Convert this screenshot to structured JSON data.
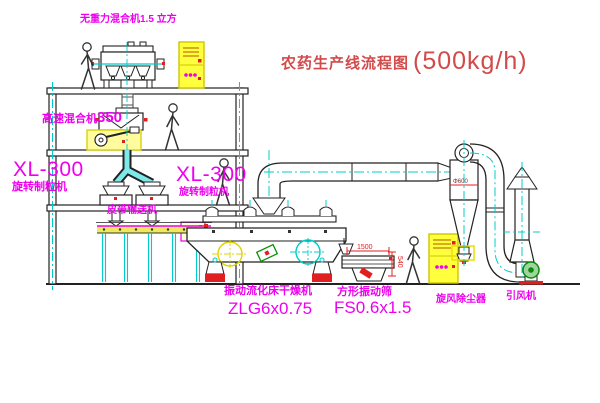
{
  "title": {
    "name": "农药生产线流程图",
    "capacity": "(500kg/h)"
  },
  "labels": {
    "gravity_mixer": "无重力混合机1.5 立方",
    "speed_mixer_name": "高速混合机",
    "speed_mixer_num": "350",
    "granulator_left_model": "XL-300",
    "granulator_left_name": "旋转制粒机",
    "granulator_right_model": "XL-300",
    "granulator_right_name": "旋转制粒机",
    "belt_conveyor": "皮带输送机",
    "dryer_name": "振动流化床干燥机",
    "dryer_model": "ZLG6x0.75",
    "sieve_name": "方形振动筛",
    "sieve_model": "FS0.6x1.5",
    "cyclone": "旋风除尘器",
    "fan": "引风机"
  },
  "dimensions": {
    "sieve_length": "1500",
    "sieve_height": "540",
    "cyclone_diameter": "Φ600"
  },
  "colors": {
    "label_magenta": "#ee00ee",
    "title_red": "#d24a4a",
    "centerline_cyan": "#00cccc",
    "highlight_yellow": "#e8e000",
    "dimension_red": "#e02020"
  }
}
